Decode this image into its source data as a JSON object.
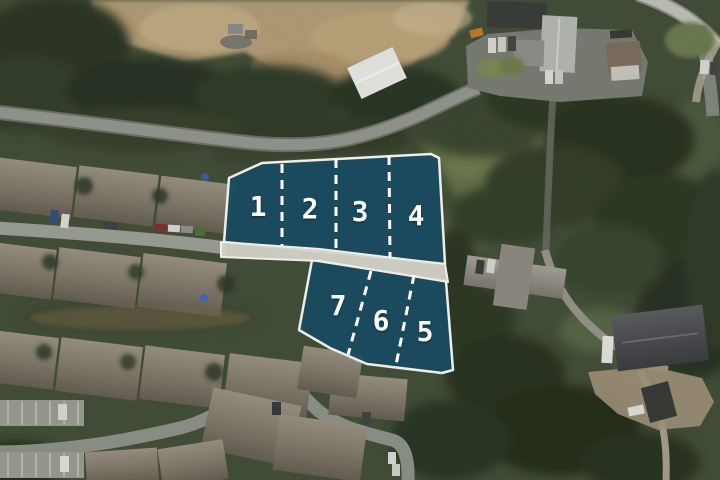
{
  "map": {
    "colors": {
      "lot_fill": "#1a4a60",
      "lot_border": "#eeede6",
      "divider": "#ffffff",
      "road_band": "#d3d1c9"
    },
    "lots": [
      {
        "label": "1"
      },
      {
        "label": "2"
      },
      {
        "label": "3"
      },
      {
        "label": "4"
      },
      {
        "label": "5"
      },
      {
        "label": "6"
      },
      {
        "label": "7"
      }
    ]
  }
}
